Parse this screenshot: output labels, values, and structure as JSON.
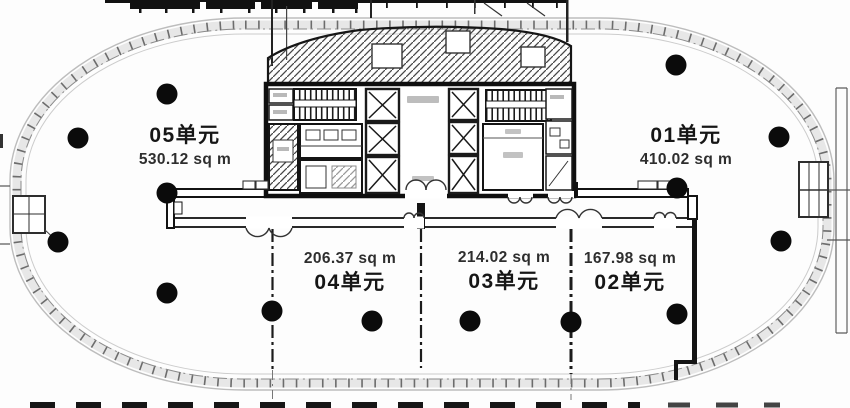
{
  "floorplan": {
    "units": {
      "u05": {
        "name": "05单元",
        "area": "530.12 sq m"
      },
      "u01": {
        "name": "01单元",
        "area": "410.02 sq m"
      },
      "u04": {
        "name": "04单元",
        "area": "206.37 sq m"
      },
      "u03": {
        "name": "03单元",
        "area": "214.02 sq m"
      },
      "u02": {
        "name": "02单元",
        "area": "167.98 sq m"
      }
    },
    "columns": [
      [
        167,
        94
      ],
      [
        78,
        138
      ],
      [
        167,
        193
      ],
      [
        676,
        65
      ],
      [
        779,
        137
      ],
      [
        677,
        188
      ],
      [
        58,
        242
      ],
      [
        167,
        293
      ],
      [
        272,
        311
      ],
      [
        372,
        321
      ],
      [
        470,
        321
      ],
      [
        571,
        322
      ],
      [
        677,
        314
      ],
      [
        781,
        241
      ]
    ],
    "colors": {
      "ink": "#141414",
      "wall": "#111111",
      "band": "#e7e7e7",
      "tick": "#4d4d4d",
      "dot": "#0b0b0b",
      "label": "#161616",
      "area_label": "#2e2e2e"
    }
  }
}
